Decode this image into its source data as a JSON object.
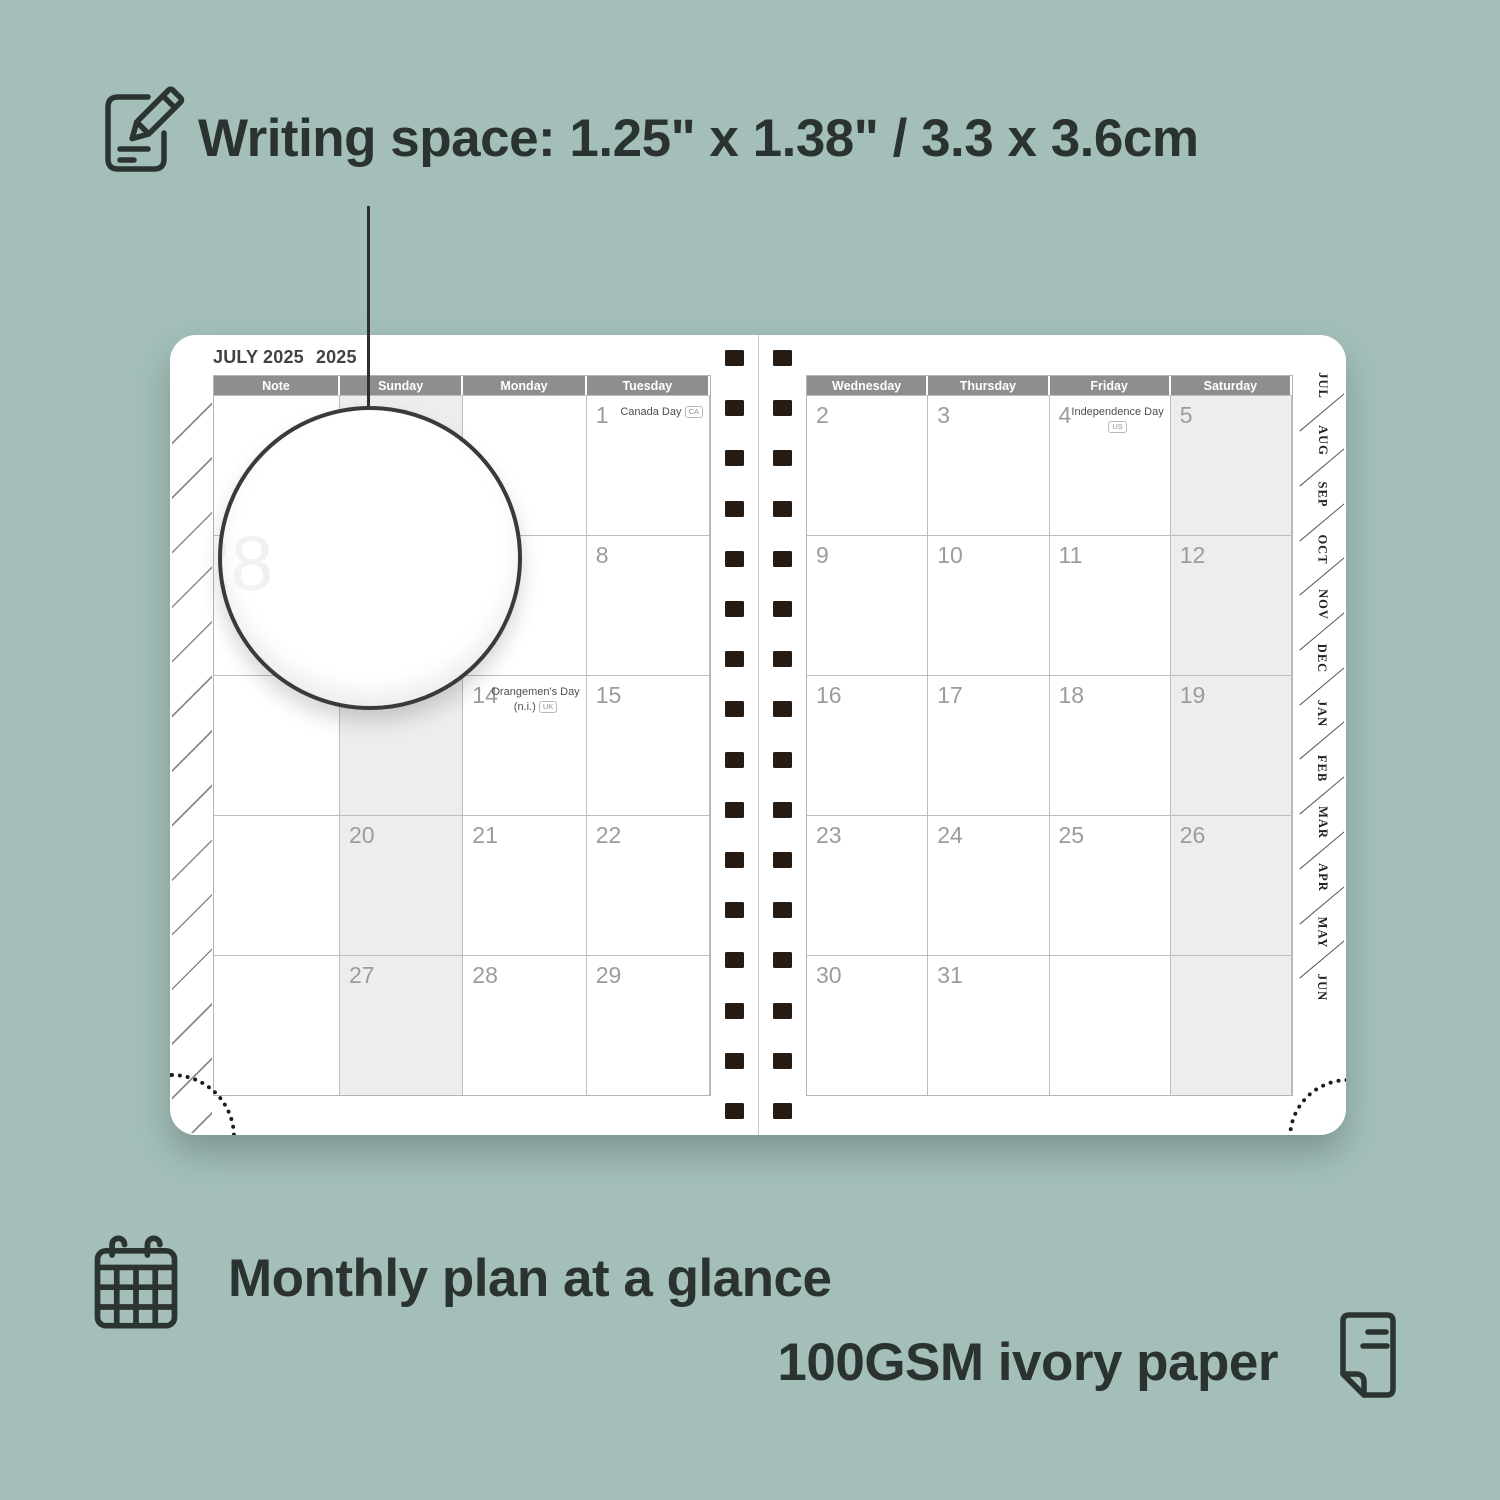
{
  "promo": {
    "writing_space": "Writing space: 1.25\" x 1.38\" / 3.3 x 3.6cm",
    "monthly_plan": "Monthly plan at a glance",
    "paper": "100GSM ivory paper"
  },
  "planner": {
    "title_month": "JULY 2025",
    "title_year": "2025",
    "left_headers": [
      "Note",
      "Sunday",
      "Monday",
      "Tuesday"
    ],
    "right_headers": [
      "Wednesday",
      "Thursday",
      "Friday",
      "Saturday"
    ],
    "week_numbers": [
      "27",
      "28",
      "29",
      "30",
      "31"
    ],
    "tabs": [
      "JUL",
      "AUG",
      "SEP",
      "OCT",
      "NOV",
      "DEC",
      "JAN",
      "FEB",
      "MAR",
      "APR",
      "MAY",
      "JUN"
    ],
    "left_rows": [
      [
        "",
        "",
        "",
        ""
      ],
      [
        "",
        "6",
        "7",
        "8"
      ],
      [
        "",
        "13",
        "",
        "15"
      ],
      [
        "",
        "20",
        "21",
        "22"
      ],
      [
        "",
        "27",
        "28",
        "29"
      ]
    ],
    "right_rows": [
      [
        "2",
        "3",
        "",
        "5"
      ],
      [
        "9",
        "10",
        "11",
        "12"
      ],
      [
        "16",
        "17",
        "18",
        "19"
      ],
      [
        "23",
        "24",
        "25",
        "26"
      ],
      [
        "30",
        "31",
        "",
        ""
      ]
    ],
    "holidays": {
      "canada": {
        "day": "1",
        "name": "Canada Day",
        "badge": "CA"
      },
      "independence": {
        "day": "4",
        "name": "Independence Day",
        "badge": "US"
      },
      "orangemen": {
        "day": "14",
        "name": "Orangemen's Day",
        "name2": "(n.i.)",
        "badge": "UK"
      }
    }
  },
  "colors": {
    "background": "#a4bfba",
    "header_bar": "#8e8e8e",
    "weekend_shade": "#ededed",
    "binding_hole": "#261a12",
    "ink": "#2b3330"
  }
}
